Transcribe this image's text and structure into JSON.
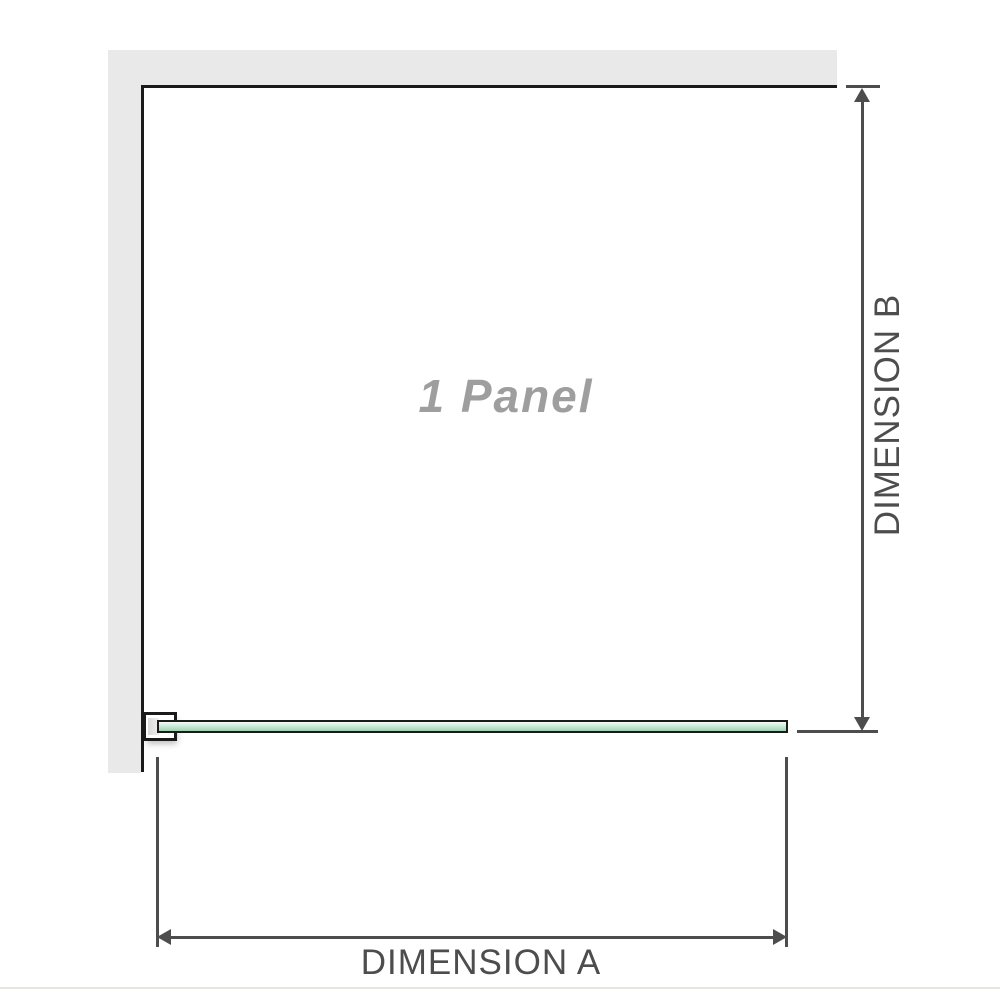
{
  "diagram": {
    "panel_label": "1 Panel",
    "dimension_a_label": "DIMENSION A",
    "dimension_b_label": "DIMENSION B"
  },
  "colors": {
    "wall": "#e9e9e9",
    "frame": "#1a1a1a",
    "dimension": "#4d4d4d",
    "panel_label": "#9e9e9e",
    "glass_light": "#f3faf5",
    "glass_mid": "#cdead9",
    "glass_dark": "#9cd2b0",
    "bracket_pad": "#d9d9d9",
    "divider": "#e8e5e1"
  }
}
